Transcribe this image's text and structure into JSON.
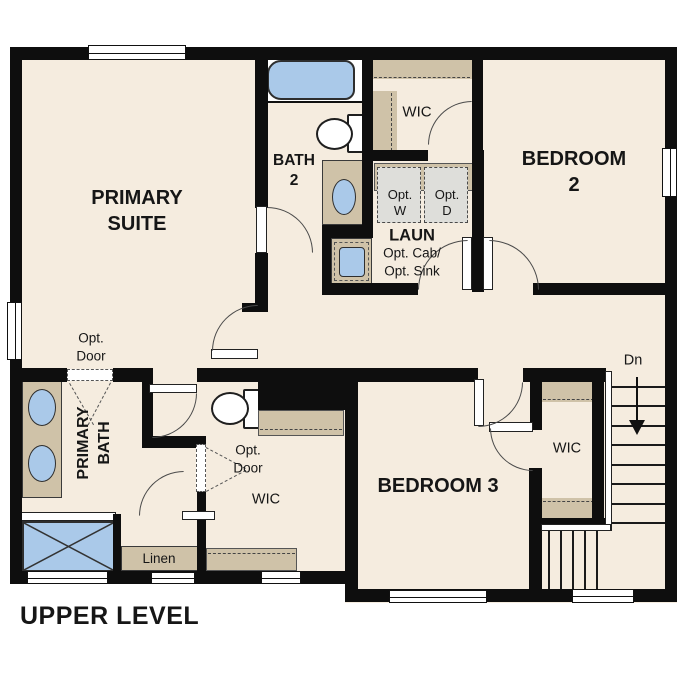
{
  "plan": {
    "title": "UPPER LEVEL",
    "rooms": {
      "primary_suite": "PRIMARY\nSUITE",
      "bath2": "BATH\n2",
      "wic_top": "WIC",
      "laundry": "LAUN",
      "laundry_options": "Opt. Cab/\nOpt. Sink",
      "opt_washer": "Opt.\nW",
      "opt_dryer": "Opt.\nD",
      "bedroom2": "BEDROOM 2",
      "primary_bath": "PRIMARY\nBATH",
      "opt_door_suite": "Opt.\nDoor",
      "opt_door_wic": "Opt.\nDoor",
      "wic_mid": "WIC",
      "linen": "Linen",
      "bedroom3": "BEDROOM 3",
      "wic_bedroom3": "WIC",
      "stairs_down": "Dn"
    },
    "colors": {
      "wall": "#0e0e0e",
      "floor": "#f5ecdf",
      "cabinet_tan": "#cfc2a8",
      "fixture_blue": "#aac9e9",
      "appliance_gray": "#dededa"
    }
  }
}
